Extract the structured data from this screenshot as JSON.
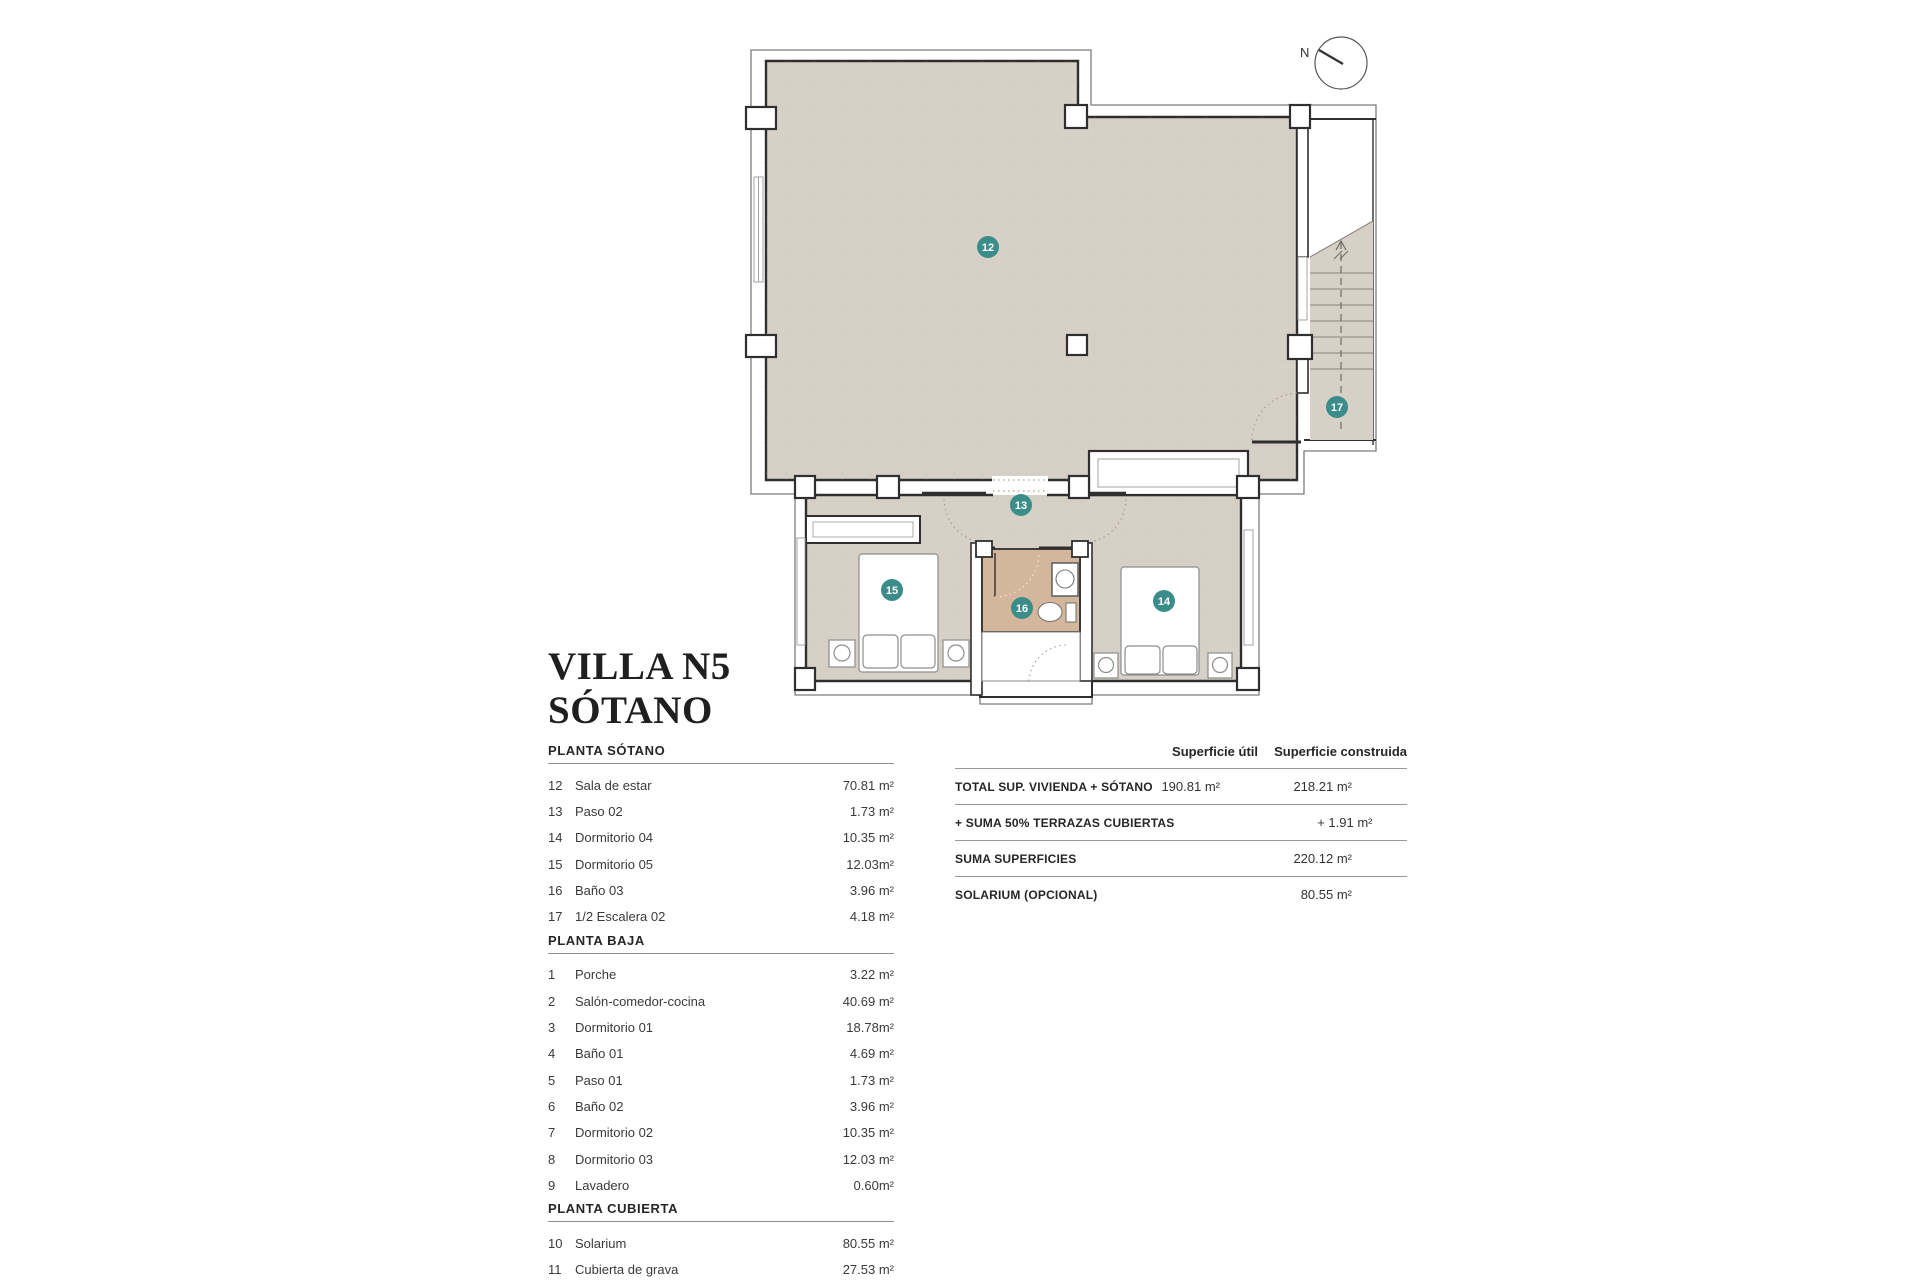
{
  "title": {
    "line1": "VILLA N5",
    "line2": "SÓTANO"
  },
  "compass": {
    "label": "N"
  },
  "room_list": {
    "sections": [
      {
        "title": "PLANTA SÓTANO",
        "rows": [
          {
            "num": "12",
            "name": "Sala de estar",
            "area": "70.81 m²"
          },
          {
            "num": "13",
            "name": "Paso 02",
            "area": "1.73 m²"
          },
          {
            "num": "14",
            "name": "Dormitorio 04",
            "area": "10.35 m²"
          },
          {
            "num": "15",
            "name": "Dormitorio 05",
            "area": "12.03m²"
          },
          {
            "num": "16",
            "name": "Baño 03",
            "area": "3.96 m²"
          },
          {
            "num": "17",
            "name": "1/2 Escalera 02",
            "area": "4.18 m²"
          }
        ]
      },
      {
        "title": "PLANTA BAJA",
        "rows": [
          {
            "num": "1",
            "name": "Porche",
            "area": "3.22 m²"
          },
          {
            "num": "2",
            "name": "Salón-comedor-cocina",
            "area": "40.69 m²"
          },
          {
            "num": "3",
            "name": "Dormitorio 01",
            "area": "18.78m²"
          },
          {
            "num": "4",
            "name": "Baño 01",
            "area": "4.69 m²"
          },
          {
            "num": "5",
            "name": "Paso 01",
            "area": "1.73 m²"
          },
          {
            "num": "6",
            "name": "Baño 02",
            "area": "3.96 m²"
          },
          {
            "num": "7",
            "name": "Dormitorio 02",
            "area": "10.35 m²"
          },
          {
            "num": "8",
            "name": "Dormitorio 03",
            "area": "12.03 m²"
          },
          {
            "num": "9",
            "name": "Lavadero",
            "area": "0.60m²"
          }
        ]
      },
      {
        "title": "PLANTA CUBIERTA",
        "rows": [
          {
            "num": "10",
            "name": "Solarium",
            "area": "80.55 m²"
          },
          {
            "num": "11",
            "name": "Cubierta de grava",
            "area": "27.53 m²"
          }
        ]
      }
    ]
  },
  "summary_table": {
    "col_headers": [
      "Superficie útil",
      "Superficie construida"
    ],
    "rows": [
      {
        "label": "TOTAL SUP. VIVIENDA + SÓTANO",
        "util": "190.81 m²",
        "constr": "218.21 m²"
      },
      {
        "label": "+ SUMA 50% TERRAZAS CUBIERTAS",
        "util": "",
        "constr": "+ 1.91 m²"
      },
      {
        "label": "SUMA SUPERFICIES",
        "util": "",
        "constr": "220.12 m²"
      },
      {
        "label": "SOLARIUM (OPCIONAL)",
        "util": "",
        "constr": "80.55 m²"
      }
    ]
  },
  "plan": {
    "badges": [
      {
        "id": "12",
        "x": 258,
        "y": 222
      },
      {
        "id": "13",
        "x": 291,
        "y": 480
      },
      {
        "id": "14",
        "x": 434,
        "y": 576
      },
      {
        "id": "15",
        "x": 162,
        "y": 565
      },
      {
        "id": "16",
        "x": 292,
        "y": 583
      },
      {
        "id": "17",
        "x": 607,
        "y": 382
      }
    ],
    "colors": {
      "floor": "#d7d0c7",
      "bathroom": "#d3b69b",
      "badge": "#3b8d8a",
      "wall": "#2f2f2f"
    }
  }
}
